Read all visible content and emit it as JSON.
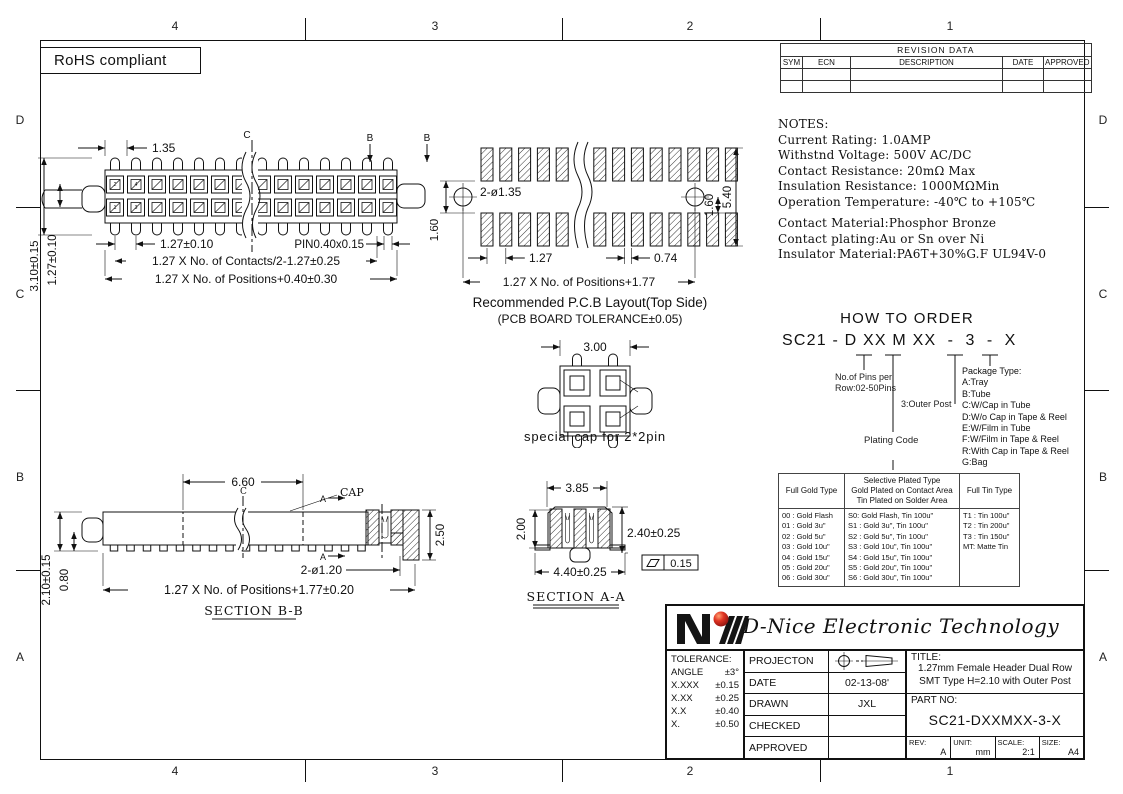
{
  "colors": {
    "line": "#111111",
    "logo_red": "#cc2222"
  },
  "sheet": {
    "zone_cols": [
      "4",
      "3",
      "2",
      "1"
    ],
    "zone_rows": [
      "D",
      "C",
      "B",
      "A"
    ],
    "rohs_label": "RoHS compliant"
  },
  "revision": {
    "title": "REVISION  DATA",
    "columns": [
      "SYM",
      "ECN",
      "DESCRIPTION",
      "DATE",
      "APPROVED"
    ]
  },
  "notes": {
    "heading": "NOTES:",
    "electrical": [
      "Current Rating: 1.0AMP",
      "Withstnd Voltage: 500V AC/DC",
      "Contact Resistance: 20mΩ Max",
      "Insulation Resistance: 1000MΩMin",
      "Operation Temperature: -40℃ to +105℃"
    ],
    "material": [
      "Contact Material:Phosphor Bronze",
      "Contact plating:Au or Sn over Ni",
      "Insulator Material:PA6T+30%G.F UL94V-0"
    ]
  },
  "order": {
    "heading": "HOW TO ORDER",
    "code": "SC21 - D XX M XX  -  3  -  X",
    "pins_note_line1": "No.of Pins per",
    "pins_note_line2": "Row:02-50Pins",
    "outer_post_note": "3:Outer Post",
    "plating_note": "Plating Code",
    "package_heading": "Package Type:",
    "package_options": [
      "A:Tray",
      "B:Tube",
      "C:W/Cap in Tube",
      "D:W/o Cap in Tape & Reel",
      "E:W/Film in Tube",
      "F:W/Film in Tape & Reel",
      "R:With Cap in Tape & Reel",
      "G:Bag"
    ]
  },
  "plating": {
    "header_gold": "Full Gold Type",
    "header_selective_1": "Selective Plated Type",
    "header_selective_2": "Gold Plated on Contact Area",
    "header_selective_3": "Tin Plated on Solder Area",
    "header_tin": "Full Tin Type",
    "gold": [
      "00 : Gold Flash",
      "01 : Gold 3u\"",
      "02 : Gold 5u\"",
      "03 : Gold 10u\"",
      "04 : Gold 15u\"",
      "05 : Gold 20u\"",
      "06 : Gold 30u\""
    ],
    "selective": [
      "S0: Gold Flash, Tin 100u\"",
      "S1 : Gold 3u\", Tin 100u\"",
      "S2 : Gold 5u\", Tin 100u\"",
      "S3 : Gold 10u\", Tin 100u\"",
      "S4 : Gold 15u\", Tin 100u\"",
      "S5 : Gold 20u\", Tin 100u\"",
      "S6 : Gold 30u\", Tin 100u\""
    ],
    "tin": [
      "T1 : Tin 100u\"",
      "T2 : Tin 200u\"",
      "T3 : Tin 150u\"",
      "MT: Matte Tin"
    ]
  },
  "titleblock": {
    "company": "D-Nice Electronic Technology",
    "tolerance_label": "TOLERANCE:",
    "tolerances": [
      {
        "k": "ANGLE",
        "v": "±3°"
      },
      {
        "k": "X.XXX",
        "v": "±0.15"
      },
      {
        "k": "X.XX",
        "v": "±0.25"
      },
      {
        "k": "X.X",
        "v": "±0.40"
      },
      {
        "k": "X.",
        "v": "±0.50"
      }
    ],
    "projection_label": "PROJECTON",
    "date_label": "DATE",
    "date_value": "02-13-08'",
    "drawn_label": "DRAWN",
    "drawn_value": "JXL",
    "checked_label": "CHECKED",
    "checked_value": "",
    "approved_label": "APPROVED",
    "approved_value": "",
    "title_label": "TITLE:",
    "title_line1": "1.27mm Female Header Dual Row",
    "title_line2": "SMT Type  H=2.10 with Outer Post",
    "part_label": "PART  NO:",
    "part_value": "SC21-DXXMXX-3-X",
    "rev_label": "REV:",
    "rev_value": "A",
    "unit_label": "UNIT:",
    "unit_value": "mm",
    "scale_label": "SCALE:",
    "scale_value": "2:1",
    "size_label": "SIZE:",
    "size_value": "A4"
  },
  "top_view": {
    "dim_lead": "1.35",
    "dim_height": "3.10±0.15",
    "dim_row_pitch": "1.27±0.10",
    "dim_pitch": "1.27±0.10",
    "dim_pin": "PIN0.40x0.15",
    "dim_contacts": "1.27 X No. of Contacts/2-1.27±0.25",
    "dim_positions": "1.27 X No. of Positions+0.40±0.30",
    "centerline": "C",
    "section": "B",
    "pin1": "1",
    "pin2": "2",
    "pin3": "3",
    "pin4": "4"
  },
  "pcb_layout": {
    "dim_holes": "2-ø1.35",
    "dim_row_gap": "1.60",
    "dim_hole_offset": "1.60",
    "dim_span": "5.40",
    "dim_pitch": "1.27",
    "dim_pad_gap": "0.74",
    "dim_positions": "1.27 X No. of Positions+1.77",
    "caption": "Recommended P.C.B Layout(Top Side)",
    "subcaption": "(PCB BOARD TOLERANCE±0.05)"
  },
  "cap_view": {
    "dim_width": "3.00",
    "caption": "special cap for 2*2pin"
  },
  "section_bb": {
    "dim_cap": "6.60",
    "cap_label": "CAP",
    "centerline": "C",
    "section": "A",
    "dim_height": "2.50",
    "dim_posts": "2-ø1.20",
    "dim_total_height": "2.10±0.15",
    "dim_standoff": "0.80",
    "dim_positions": "1.27 X No. of Positions+1.77±0.20",
    "caption": "SECTION B-B"
  },
  "section_aa": {
    "dim_width": "3.85",
    "dim_housing_height": "2.00",
    "dim_height": "2.40±0.25",
    "dim_flatness": "0.15",
    "dim_base": "4.40±0.25",
    "caption": "SECTION A-A"
  }
}
